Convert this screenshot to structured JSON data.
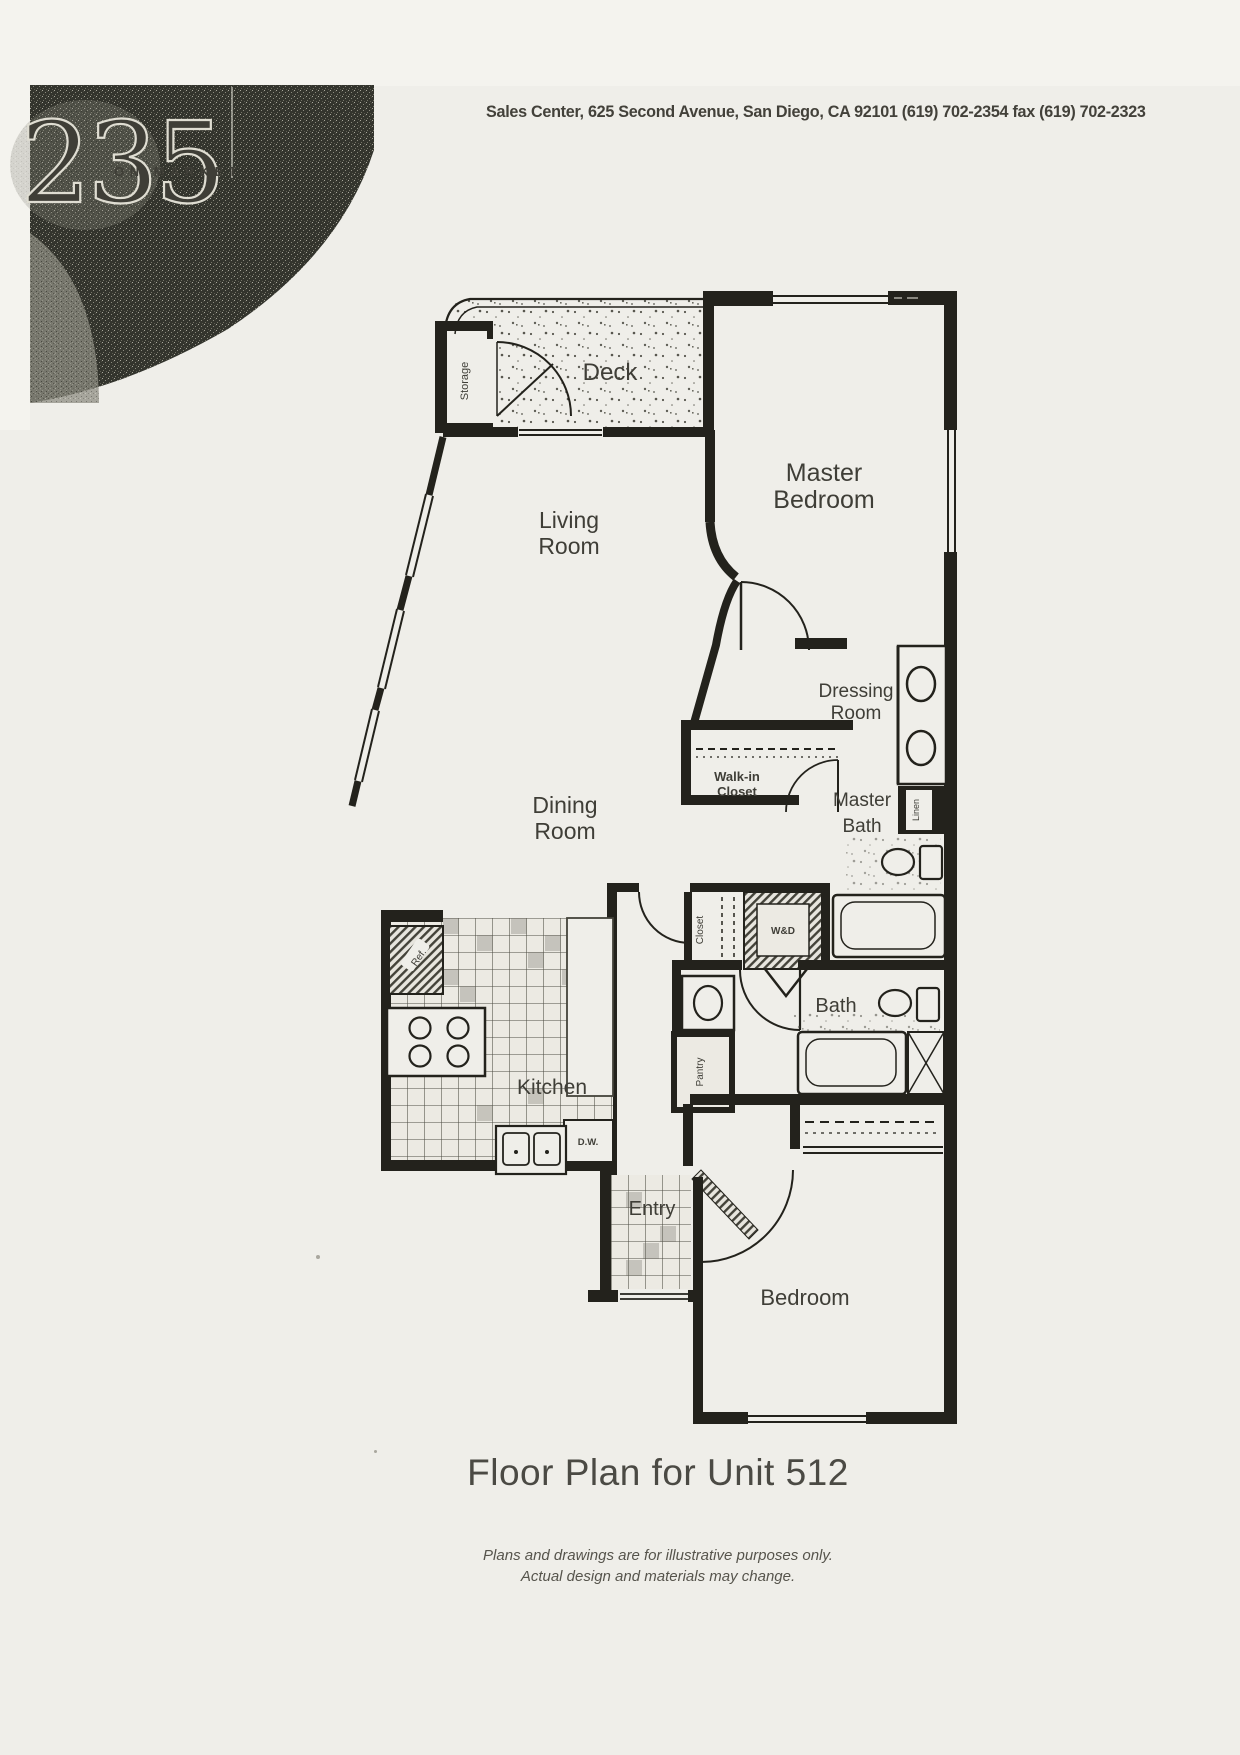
{
  "header": {
    "address": "Sales Center, 625 Second Avenue, San Diego, CA 92101 (619) 702-2354 fax (619) 702-2323"
  },
  "logo": {
    "number": "235",
    "tagline": "ON MARKET"
  },
  "plan": {
    "rooms": {
      "deck": "Deck",
      "storage": "Storage",
      "master_bedroom": [
        "Master",
        "Bedroom"
      ],
      "living_room": [
        "Living",
        "Room"
      ],
      "dining_room": [
        "Dining",
        "Room"
      ],
      "dressing_room": [
        "Dressing",
        "Room"
      ],
      "walk_in_closet": [
        "Walk-in",
        "Closet"
      ],
      "master_bath": [
        "Master",
        "Bath"
      ],
      "linen": "Linen",
      "closet": "Closet",
      "washer_dryer": "W&D",
      "bath": "Bath",
      "pantry": "Pantry",
      "refrigerator": "Ref.",
      "dishwasher": "D.W.",
      "kitchen": "Kitchen",
      "entry": "Entry",
      "bedroom": "Bedroom"
    }
  },
  "footer": {
    "title": "Floor Plan for Unit 512",
    "disclaimer": [
      "Plans and drawings are for illustrative purposes only.",
      "Actual design and materials may change."
    ]
  },
  "colors": {
    "paper": "#efeee9",
    "ink": "#23221c",
    "text": "#4a4842",
    "logo_dark": "#33342d"
  }
}
